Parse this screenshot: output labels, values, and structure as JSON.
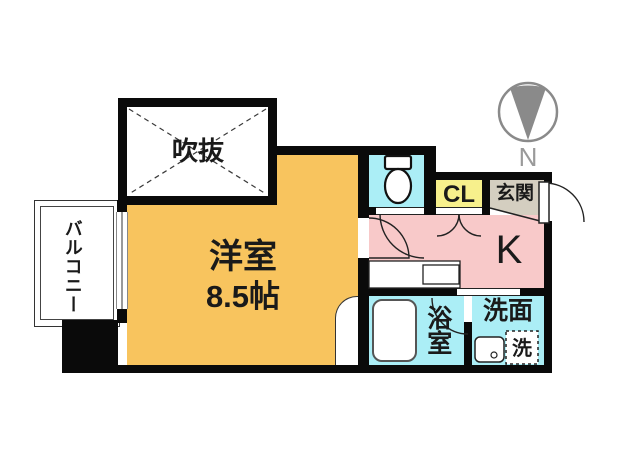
{
  "plan": {
    "type": "apartment-floor-plan",
    "rooms": {
      "main": {
        "label": "洋室",
        "size": "8.5帖",
        "color": "#F8C45E"
      },
      "void": {
        "label": "吹抜",
        "color": "#FFFFFF"
      },
      "balcony": {
        "label": "バルコニー",
        "color": "#FFFFFF"
      },
      "kitchen": {
        "label": "K",
        "color": "#F8C9C9"
      },
      "closet": {
        "label": "CL",
        "color": "#F7F08C"
      },
      "entrance": {
        "label": "玄関",
        "color": "#D4CEC0"
      },
      "bathroom": {
        "label": "浴室",
        "color": "#ABEEF6"
      },
      "washroom": {
        "label": "洗面",
        "color": "#ABEEF6"
      },
      "toilet": {
        "label": "",
        "color": "#ABEEF6"
      }
    },
    "fixtures": {
      "washer_label": "洗",
      "icons": [
        "toilet-icon",
        "bathtub-icon",
        "sink-icon",
        "washing-machine-icon",
        "kitchen-counter-icon",
        "entrance-door-icon",
        "window-icon",
        "compass-icon"
      ]
    },
    "compass": {
      "label": "N",
      "needle_color": "#8A8A8A"
    },
    "wall_color": "#0A0A0A"
  }
}
